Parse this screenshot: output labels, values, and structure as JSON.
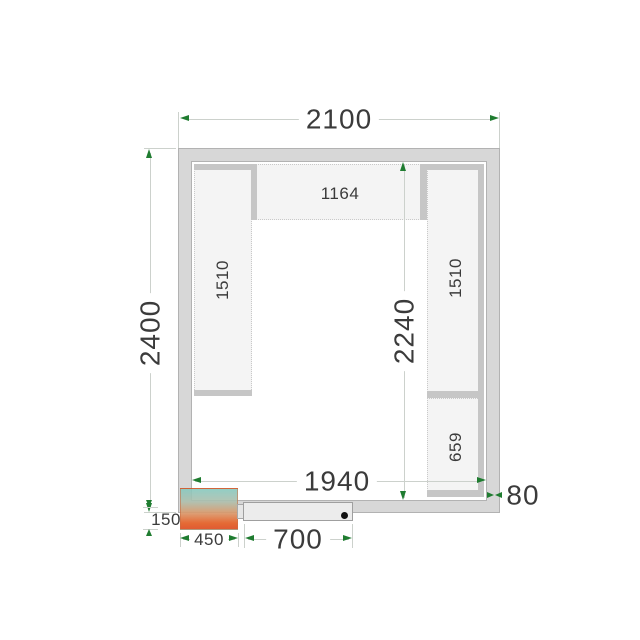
{
  "drawing": {
    "overall": {
      "width_label": "2100",
      "height_label": "2400"
    },
    "interior": {
      "width_label": "1940",
      "height_label": "2240"
    },
    "wall": {
      "thickness_label": "80"
    },
    "shelves": {
      "top_label": "1164",
      "left_label": "1510",
      "right_upper_label": "1510",
      "right_lower_label": "659"
    },
    "cooling_unit": {
      "width_label": "450",
      "protrusion_label": "150"
    },
    "door": {
      "width_label": "700"
    }
  },
  "colors": {
    "arrow_green": "#1f7c30",
    "wall_fill": "#d7d7d7",
    "shelf_fill": "#f4f4f4",
    "dim_line": "#ccd1cc",
    "text": "#3b3b3b",
    "unit_gradient_top": "#87c9bf",
    "unit_gradient_bottom": "#dc4a1d"
  }
}
